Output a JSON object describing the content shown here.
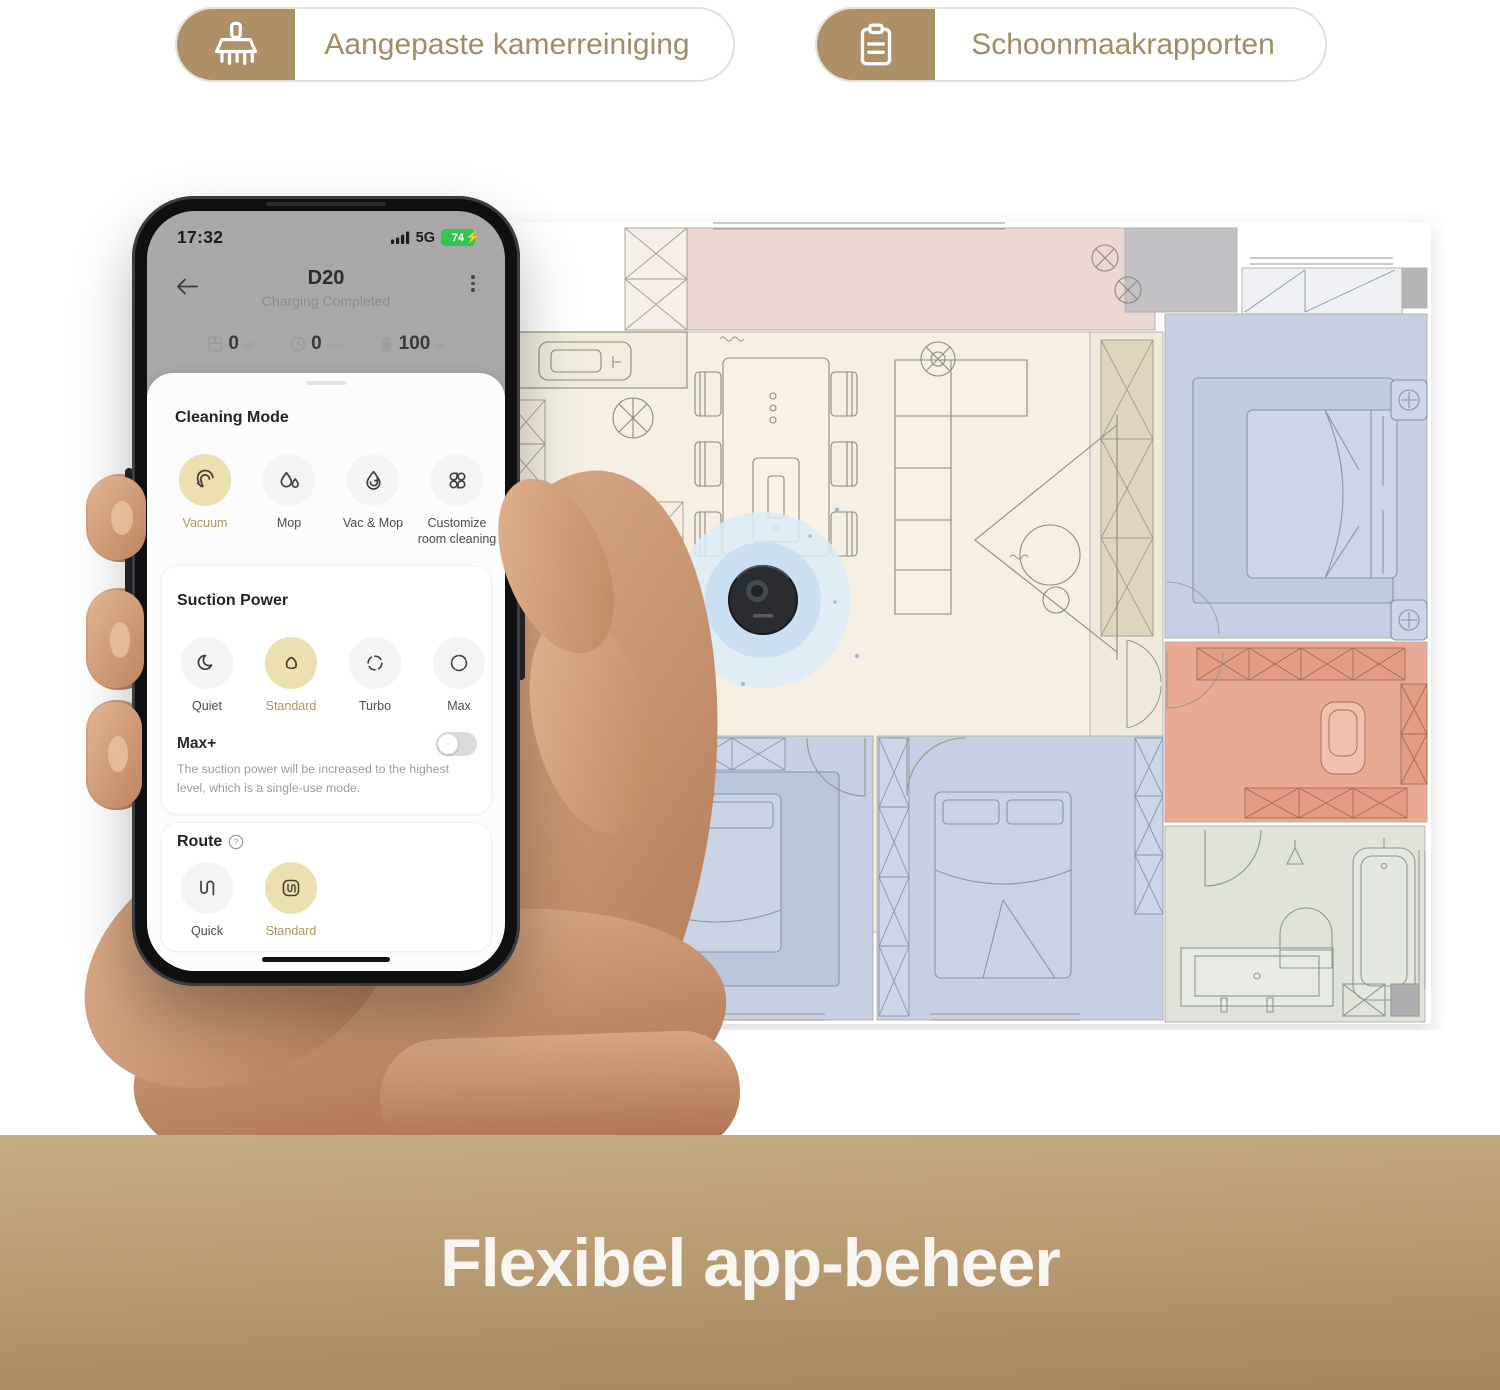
{
  "badges": [
    {
      "icon": "broom-icon",
      "label": "Aangepaste kamerreiniging"
    },
    {
      "icon": "clipboard-icon",
      "label": "Schoonmaakrapporten"
    }
  ],
  "phone": {
    "status_bar": {
      "time": "17:32",
      "network": "5G",
      "battery_percent": "74"
    },
    "header": {
      "title": "D20",
      "subtitle": "Charging Completed"
    },
    "stats": [
      {
        "value": "0",
        "unit": "m²"
      },
      {
        "value": "0",
        "unit": "min"
      },
      {
        "value": "100",
        "unit": "%"
      }
    ],
    "cleaning_mode": {
      "title": "Cleaning Mode",
      "options": [
        {
          "label": "Vacuum",
          "selected": true
        },
        {
          "label": "Mop",
          "selected": false
        },
        {
          "label": "Vac & Mop",
          "selected": false
        },
        {
          "label": "Customize room cleaning",
          "selected": false
        }
      ]
    },
    "suction_power": {
      "title": "Suction Power",
      "options": [
        {
          "label": "Quiet",
          "selected": false
        },
        {
          "label": "Standard",
          "selected": true
        },
        {
          "label": "Turbo",
          "selected": false
        },
        {
          "label": "Max",
          "selected": false
        }
      ]
    },
    "max_plus": {
      "label": "Max+",
      "enabled": false,
      "description": "The suction power will be increased to the highest level, which is a single-use mode."
    },
    "route": {
      "title": "Route",
      "options": [
        {
          "label": "Quick",
          "selected": false
        },
        {
          "label": "Standard",
          "selected": true
        }
      ]
    }
  },
  "banner": {
    "title": "Flexibel app-beheer"
  },
  "colors": {
    "accent_gold": "#ae9068",
    "selected_circle": "#ecdfb0",
    "battery_green": "#30c554",
    "floor_living": "#f4efe2",
    "floor_balcony": "#ecd8d2",
    "floor_bedroom_blue": "#c6d0e2",
    "floor_bath_salmon": "#e9a995",
    "floor_bath_green": "#dfe3da",
    "robot_ripple": "#c9def2",
    "banner_gold": "#b99c74"
  }
}
